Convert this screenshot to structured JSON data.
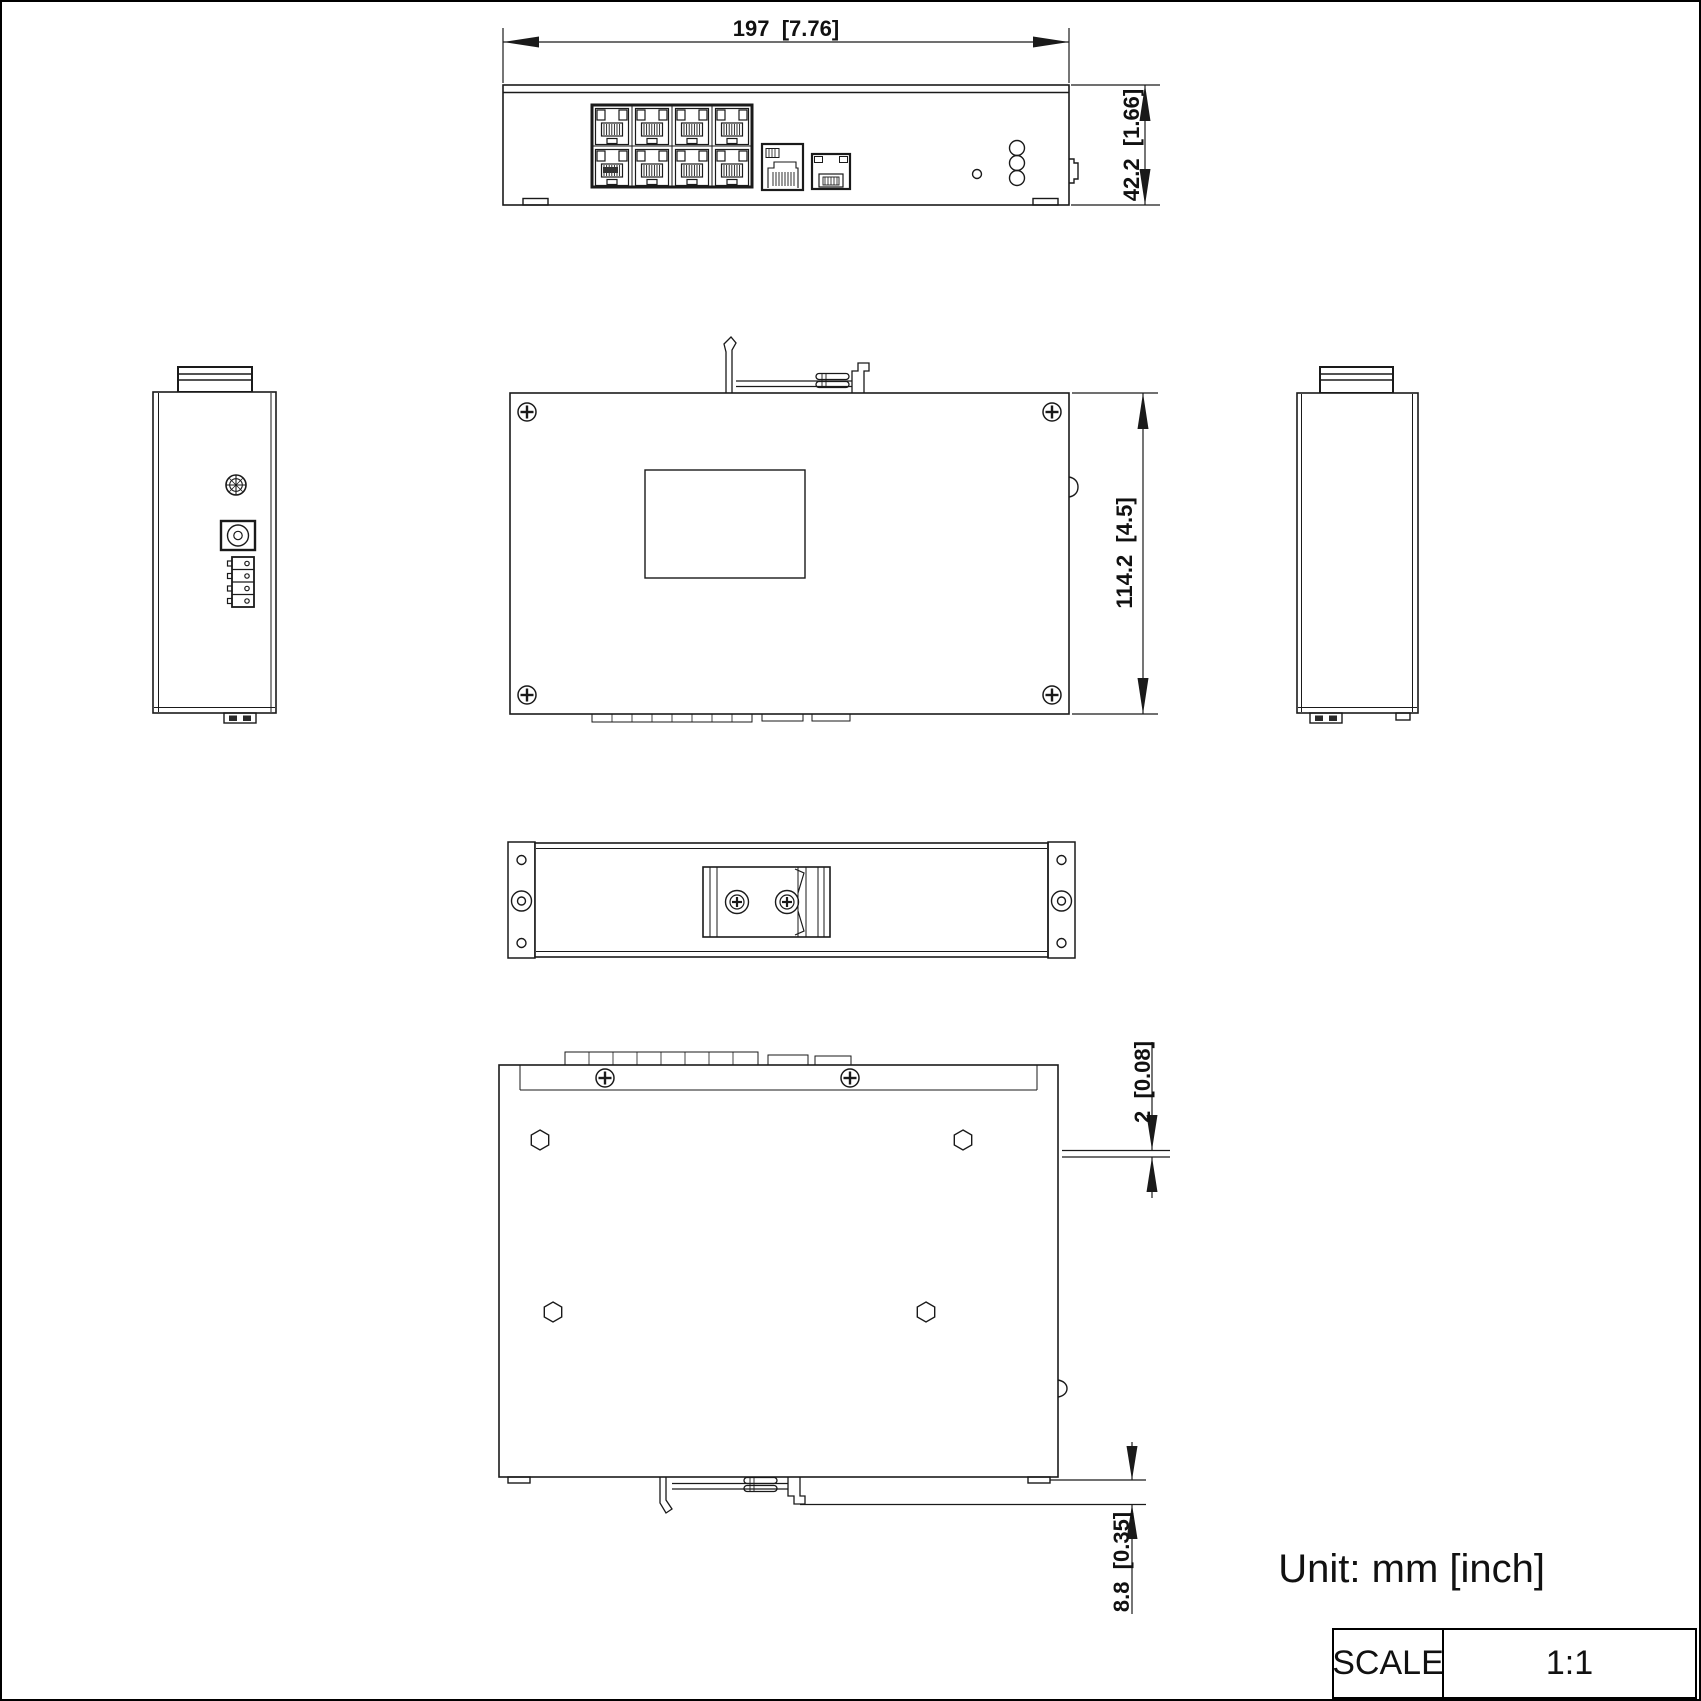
{
  "sheet": {
    "unit_note": "Unit: mm [inch]",
    "scale": {
      "label": "SCALE",
      "value": "1:1"
    }
  },
  "dimensions": {
    "overall_width": "197  [7.76]",
    "front_height": "42.2  [1.66]",
    "body_depth": "114.2  [4.5]",
    "rear_lip": "2  [0.08]",
    "din_clip_protrusion": "8.8  [0.35]"
  }
}
